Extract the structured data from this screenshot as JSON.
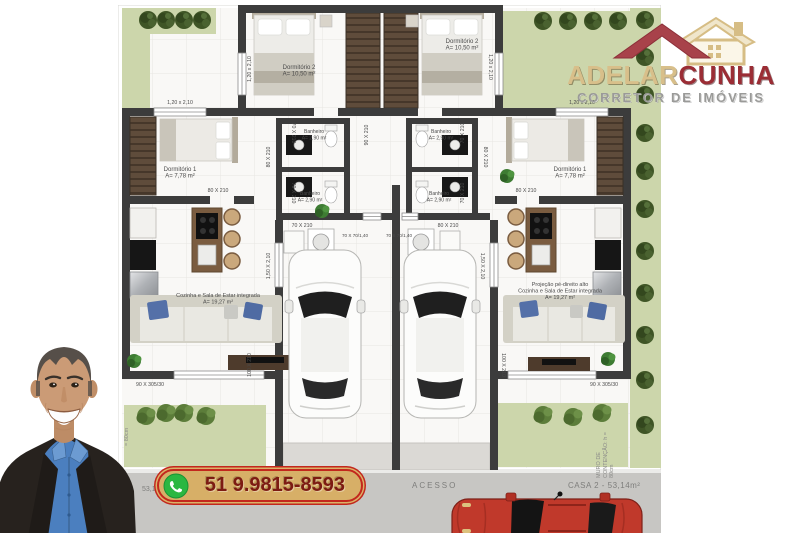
{
  "colors": {
    "wall": "#3c3c3c",
    "garden": "#ccd6ab",
    "road": "#c7c6c3",
    "logo_tan": "#d8bf8a",
    "logo_red": "#9b2d35",
    "phone_bg": "#d7af67",
    "phone_border": "#c3271d",
    "phone_text": "#7d1b12",
    "whatsapp_green": "#2bb741"
  },
  "logo": {
    "brand_first": "ADELAR",
    "brand_second": "CUNHA",
    "subtitle": "CORRETOR DE IMÓVEIS"
  },
  "contact": {
    "phone": "51 9.9815-8593"
  },
  "road": {
    "access": "ACESSO",
    "casa2": "CASA 2 - 53,14m²",
    "casa1_partial": "53,1",
    "wall_note_right": "MURO DE\nCONTENÇÃO: h =\n80cm",
    "wall_note_left": "= 80cm"
  },
  "plan": {
    "labels": [
      {
        "text": "1,20 x 2,10",
        "x": 62,
        "y": 99
      },
      {
        "text": "1,20 x 2,10",
        "x": 133,
        "y": 64,
        "rot": -90
      },
      {
        "text": "1,20 x 2,10",
        "x": 371,
        "y": 62,
        "rot": 90
      },
      {
        "text": "1,20 x 2,10",
        "x": 464,
        "y": 99
      },
      {
        "text": "Dormitório 1\nA= 7,78 m²",
        "x": 62,
        "y": 166,
        "size": 6
      },
      {
        "text": "Dormitório 1\nA= 7,78 m²",
        "x": 452,
        "y": 166,
        "size": 6
      },
      {
        "text": "Dormitório 2\nA= 10,50 m²",
        "x": 181,
        "y": 64,
        "size": 6
      },
      {
        "text": "Dormitório 2\nA= 10,50 m²",
        "x": 344,
        "y": 38,
        "size": 6
      },
      {
        "text": "Banheiro\nA= 2,90 m²",
        "x": 196,
        "y": 128,
        "size": 5
      },
      {
        "text": "Banheiro\nA= 2,90 m²",
        "x": 192,
        "y": 190,
        "size": 5
      },
      {
        "text": "Banheiro\nA= 2,90 m²",
        "x": 323,
        "y": 128,
        "size": 5
      },
      {
        "text": "Banheiro\nA= 2,90 m²",
        "x": 321,
        "y": 190,
        "size": 5
      },
      {
        "text": "Cozinha e Sala de Estar integrada\nA= 19,27 m²",
        "x": 100,
        "y": 292,
        "size": 5.5
      },
      {
        "text": "Projeção pé-direito alto\nCozinha e Sala de Estar integrada\nA= 19,27 m²",
        "x": 442,
        "y": 281,
        "size": 5.5
      },
      {
        "text": "80 X 210",
        "x": 100,
        "y": 187
      },
      {
        "text": "80 X 210",
        "x": 408,
        "y": 187
      },
      {
        "text": "80 X 210",
        "x": 152,
        "y": 152,
        "rot": -90
      },
      {
        "text": "80 X 210",
        "x": 366,
        "y": 152,
        "rot": 90
      },
      {
        "text": "70 X 210",
        "x": 174,
        "y": 128,
        "rot": 90
      },
      {
        "text": "70 X 210",
        "x": 174,
        "y": 188,
        "rot": 90
      },
      {
        "text": "70 X 210",
        "x": 346,
        "y": 128,
        "rot": -90
      },
      {
        "text": "70 X 210",
        "x": 346,
        "y": 188,
        "rot": -90
      },
      {
        "text": "70 X 210",
        "x": 184,
        "y": 222
      },
      {
        "text": "80 X 210",
        "x": 330,
        "y": 222
      },
      {
        "text": "90 X 210",
        "x": 250,
        "y": 130,
        "rot": -90
      },
      {
        "text": "70 X 70/1,40",
        "x": 237,
        "y": 232,
        "size": 4.6
      },
      {
        "text": "70 X 70/1,40",
        "x": 281,
        "y": 232,
        "size": 4.6
      },
      {
        "text": "1,50 X 2,10",
        "x": 152,
        "y": 261,
        "rot": -90
      },
      {
        "text": "1,50 X 2,10",
        "x": 363,
        "y": 261,
        "rot": 90
      },
      {
        "text": "100 X 210",
        "x": 133,
        "y": 360,
        "rot": -90
      },
      {
        "text": "100 X 210",
        "x": 384,
        "y": 360,
        "rot": 90
      },
      {
        "text": "90 X 305/30",
        "x": 32,
        "y": 381
      },
      {
        "text": "90 X 305/30",
        "x": 486,
        "y": 381
      }
    ]
  }
}
